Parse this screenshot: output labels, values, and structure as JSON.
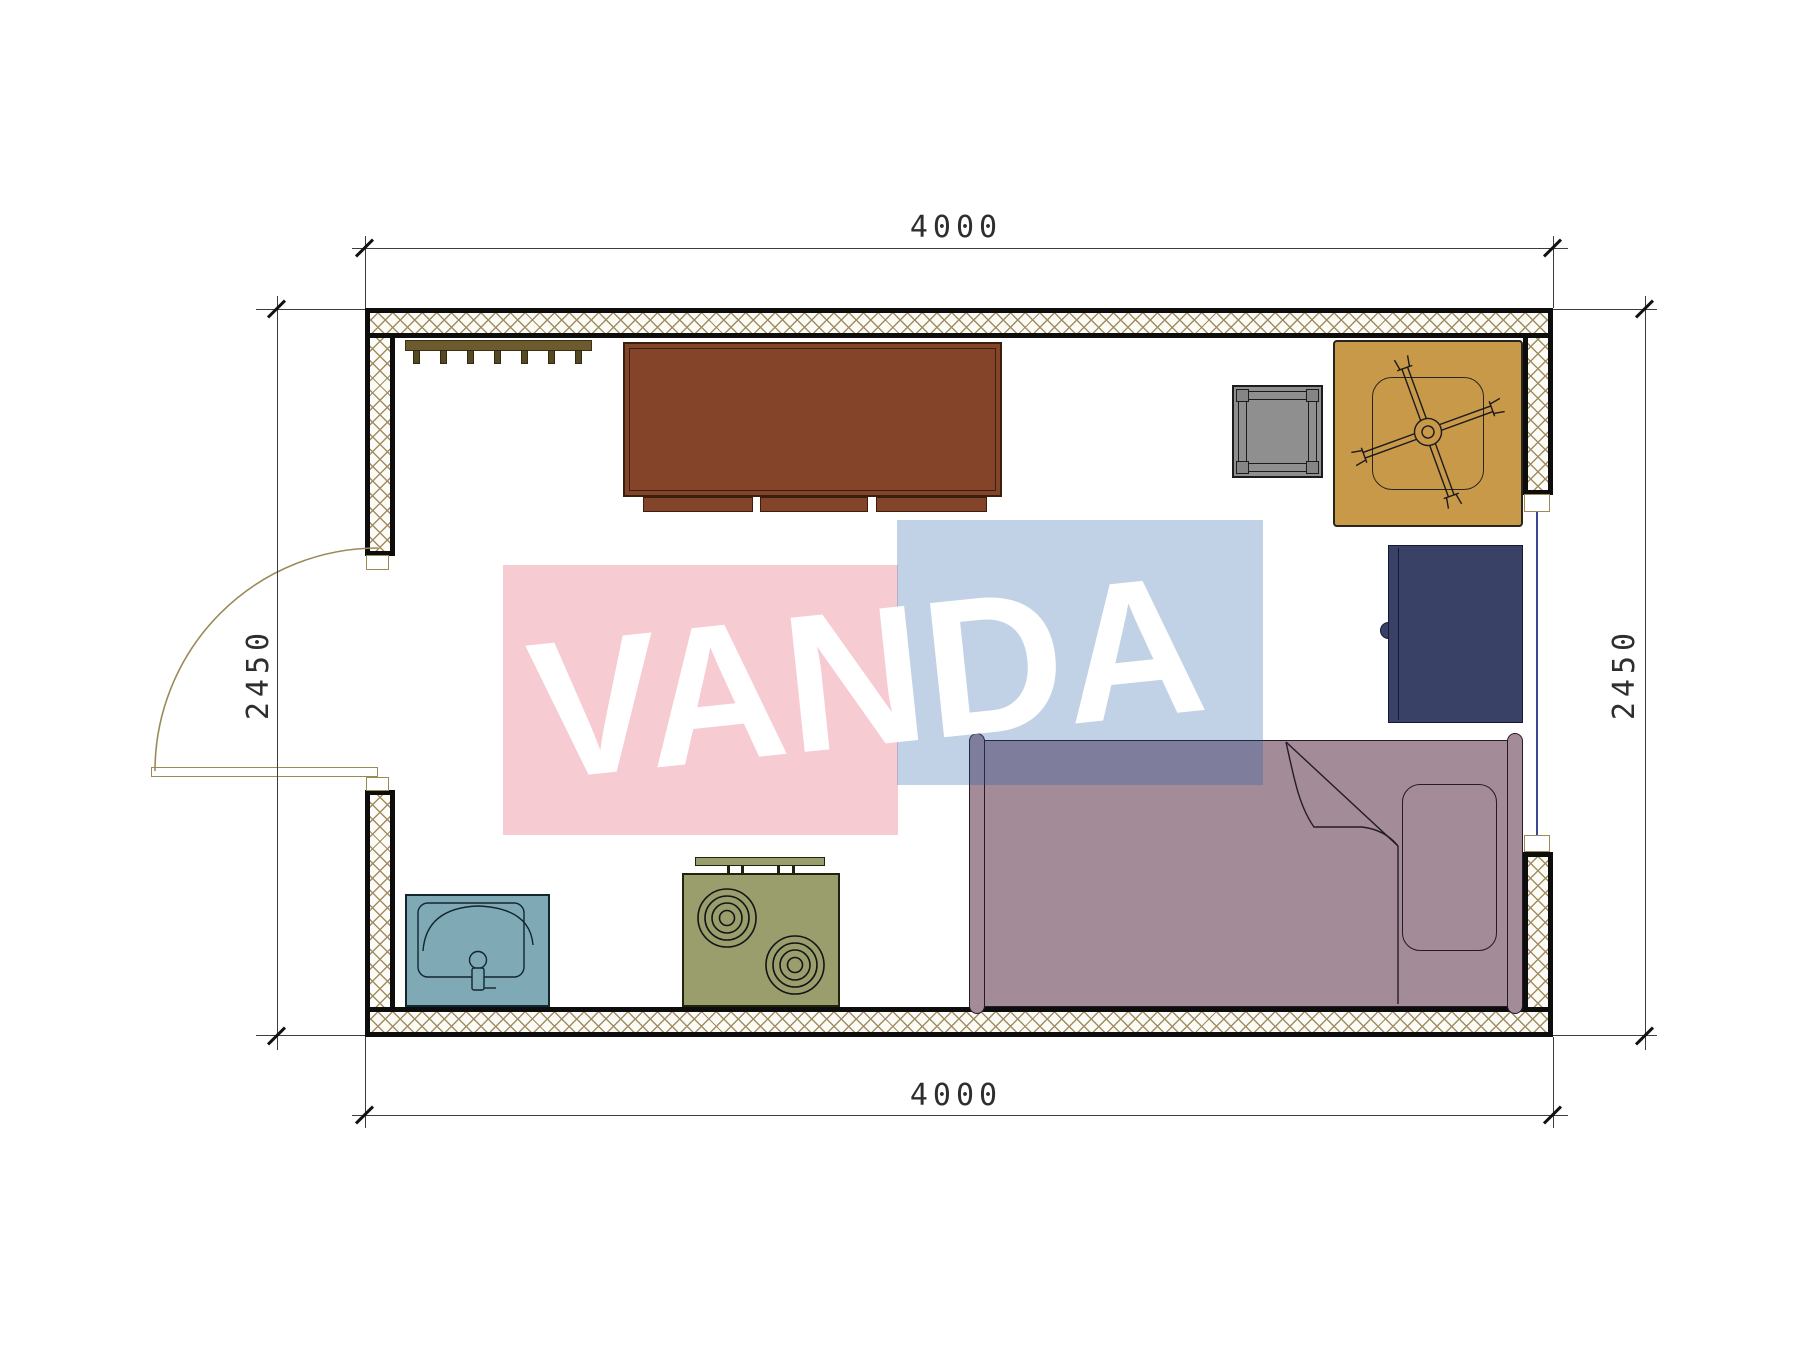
{
  "title": "container-house-floor-plan",
  "dimensions": {
    "top": "4000",
    "bottom": "4000",
    "left": "2450",
    "right": "2450"
  },
  "watermark": {
    "text": "VANDA",
    "pink_fill": "#e23e58",
    "blue_fill": "#1958a8",
    "opacity": 0.27,
    "text_color": "#ffffff"
  },
  "rooms": {
    "main_room": {
      "width_mm": 4000,
      "height_mm": 2450,
      "features": [
        "door-left-wall",
        "window-right-wall"
      ]
    }
  },
  "furniture": [
    {
      "name": "coat-rack",
      "hooks": 7
    },
    {
      "name": "desk"
    },
    {
      "name": "stool"
    },
    {
      "name": "table-with-fan"
    },
    {
      "name": "refrigerator"
    },
    {
      "name": "single-bed",
      "parts": [
        "headboard",
        "footboard",
        "pillow",
        "folded-blanket"
      ]
    },
    {
      "name": "sink"
    },
    {
      "name": "stove",
      "burners": 2
    }
  ],
  "colors": {
    "wall-line": "#0d0d0d",
    "wall-bg": "#fcfbf6",
    "hatch-line": "#a08e62",
    "dim-line": "#3c3c3c",
    "dim-text": "#2e2e2e",
    "tick": "#111111",
    "door-line": "#9b8a58",
    "window-glass": "#3c4794",
    "rack": "#6b5b2e",
    "rack-dark": "#544923",
    "desk": "#84442a",
    "desk-line": "#3a1e0e",
    "stool": "#8f8f8f",
    "stool-line": "#1c1c1c",
    "stool-foot": "#858585",
    "table": "#c9994a",
    "table-line": "#26261f",
    "fridge": "#3a4166",
    "fridge-line": "#141a33",
    "bed": "#a38b97",
    "bed-line": "#241a28",
    "sink": "#7fa9b5",
    "sink-line": "#122630",
    "stove": "#999e6c",
    "stove-line": "#20240f"
  }
}
